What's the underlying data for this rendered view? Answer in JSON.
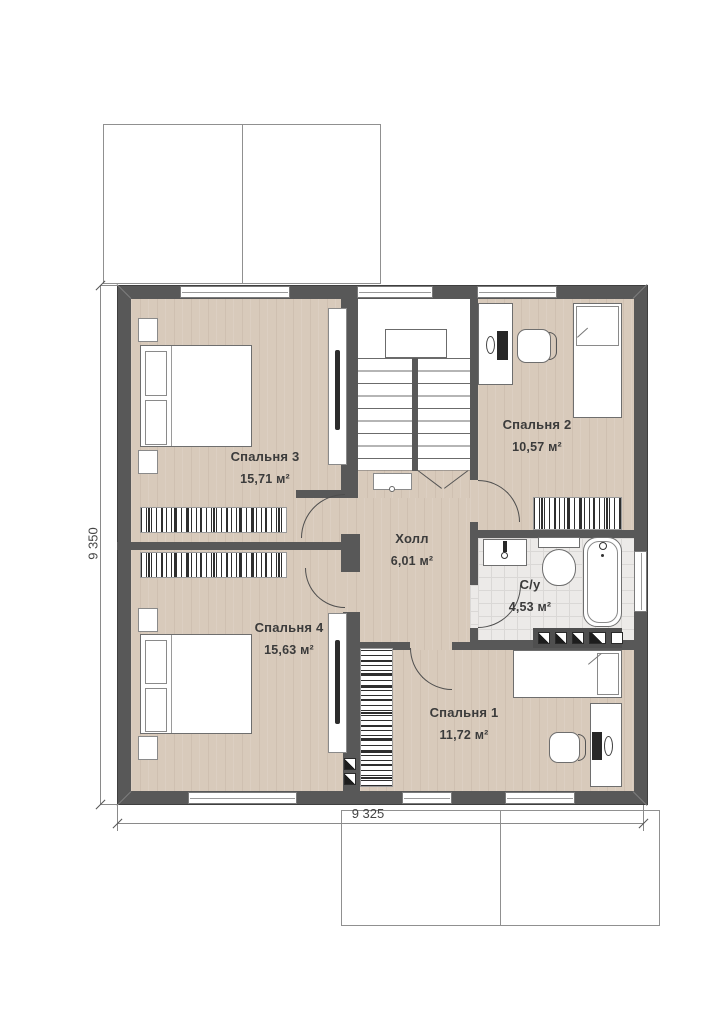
{
  "plan": {
    "rooms": [
      {
        "name": "Спальня 3",
        "area": "15,71 м²"
      },
      {
        "name": "Спальня 2",
        "area": "10,57 м²"
      },
      {
        "name": "Холл",
        "area": "6,01 м²"
      },
      {
        "name": "С/у",
        "area": "4,53 м²"
      },
      {
        "name": "Спальня 4",
        "area": "15,63 м²"
      },
      {
        "name": "Спальня 1",
        "area": "11,72 м²"
      }
    ],
    "dimensions": {
      "vertical": "9 350",
      "horizontal": "9 325"
    },
    "colors": {
      "wall": "#585858",
      "floor": "#d8cabb",
      "tile": "#eceae8"
    },
    "symbols": [
      "double-bed",
      "single-bed",
      "wardrobe",
      "desk",
      "chair",
      "toilet",
      "sink",
      "bathtub",
      "staircase",
      "tv-panel",
      "door-arc",
      "window"
    ]
  }
}
